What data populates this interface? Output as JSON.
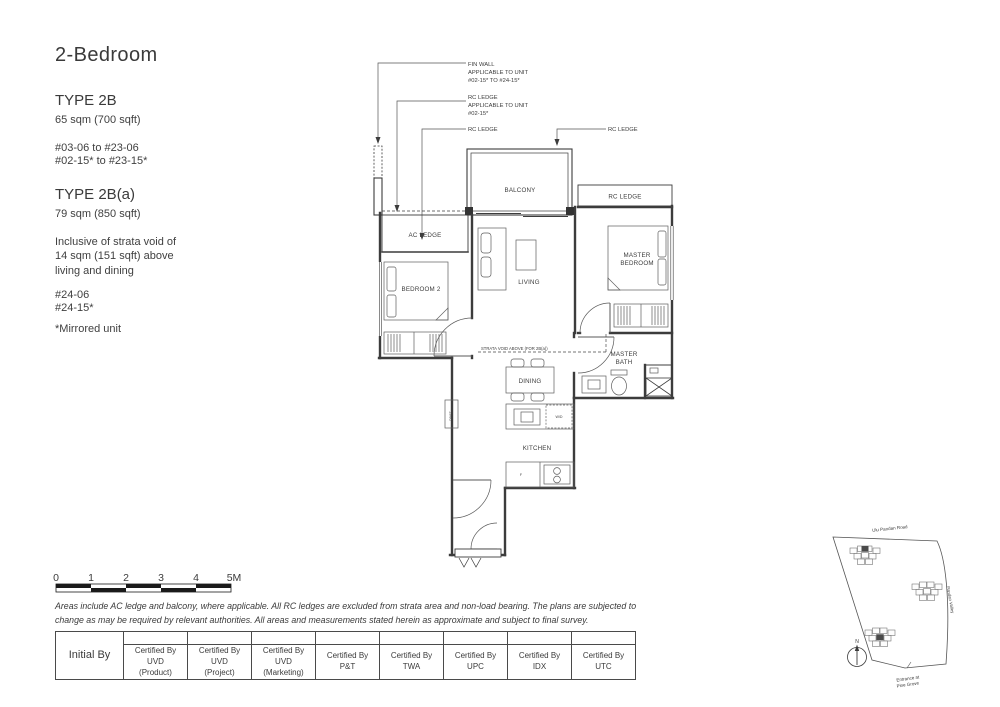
{
  "header": {
    "title": "2-Bedroom"
  },
  "unit_types": [
    {
      "name": "TYPE 2B",
      "area": "65 sqm (700 sqft)",
      "stack_lines": [
        "#03-06  to #23-06",
        "#02-15* to #23-15*"
      ]
    },
    {
      "name": "TYPE 2B(a)",
      "area": "79 sqm (850 sqft)",
      "note": "Inclusive of strata void of 14 sqm (151 sqft) above living and dining",
      "stack_lines": [
        "#24-06",
        "#24-15*"
      ]
    }
  ],
  "mirrored_note": "*Mirrored unit",
  "plan": {
    "callouts": {
      "fin_wall": [
        "FIN WALL",
        "APPLICABLE TO UNIT",
        "#02-15* TO #24-15*"
      ],
      "rc_ledge_unit": [
        "RC LEDGE",
        "APPLICABLE TO UNIT",
        "#02-15*"
      ],
      "rc_ledge_a": "RC LEDGE",
      "rc_ledge_b": "RC LEDGE"
    },
    "rooms": {
      "balcony": "BALCONY",
      "rc_ledge": "RC LEDGE",
      "ac_ledge": "AC LEDGE",
      "bedroom2": "BEDROOM 2",
      "living": "LIVING",
      "master_bedroom_l1": "MASTER",
      "master_bedroom_l2": "BEDROOM",
      "master_bath_l1": "MASTER",
      "master_bath_l2": "BATH",
      "dining": "DINING",
      "kitchen": "KITCHEN",
      "strata_void": "STRATA VOID ABOVE (FOR 2B(a))",
      "wd": "W/D",
      "fridge": "F",
      "dbst": "DB/ST"
    }
  },
  "scale_bar": {
    "labels": [
      "0",
      "1",
      "2",
      "3",
      "4",
      "5M"
    ]
  },
  "disclaimer": "Areas include AC ledge and balcony, where applicable. All RC ledges are excluded from strata area and non-load bearing. The plans are subjected to change as may be required by relevant authorities. All areas and measurements stated herein as approximate and subject to final survey.",
  "approval_table": {
    "initial_by": "Initial By",
    "certified": [
      [
        "Certified By",
        "UVD",
        "(Product)"
      ],
      [
        "Certified By",
        "UVD",
        "(Project)"
      ],
      [
        "Certified By",
        "UVD",
        "(Marketing)"
      ],
      [
        "Certified By",
        "P&T"
      ],
      [
        "Certified By",
        "TWA"
      ],
      [
        "Certified By",
        "UPC"
      ],
      [
        "Certified By",
        "IDX"
      ],
      [
        "Certified By",
        "UTC"
      ]
    ]
  },
  "site_map": {
    "road_top": "Ulu Pandan Road",
    "road_right": "Pandan Valley",
    "entrance_l1": "Entrance at",
    "entrance_l2": "Pine Grove",
    "compass": "N"
  }
}
